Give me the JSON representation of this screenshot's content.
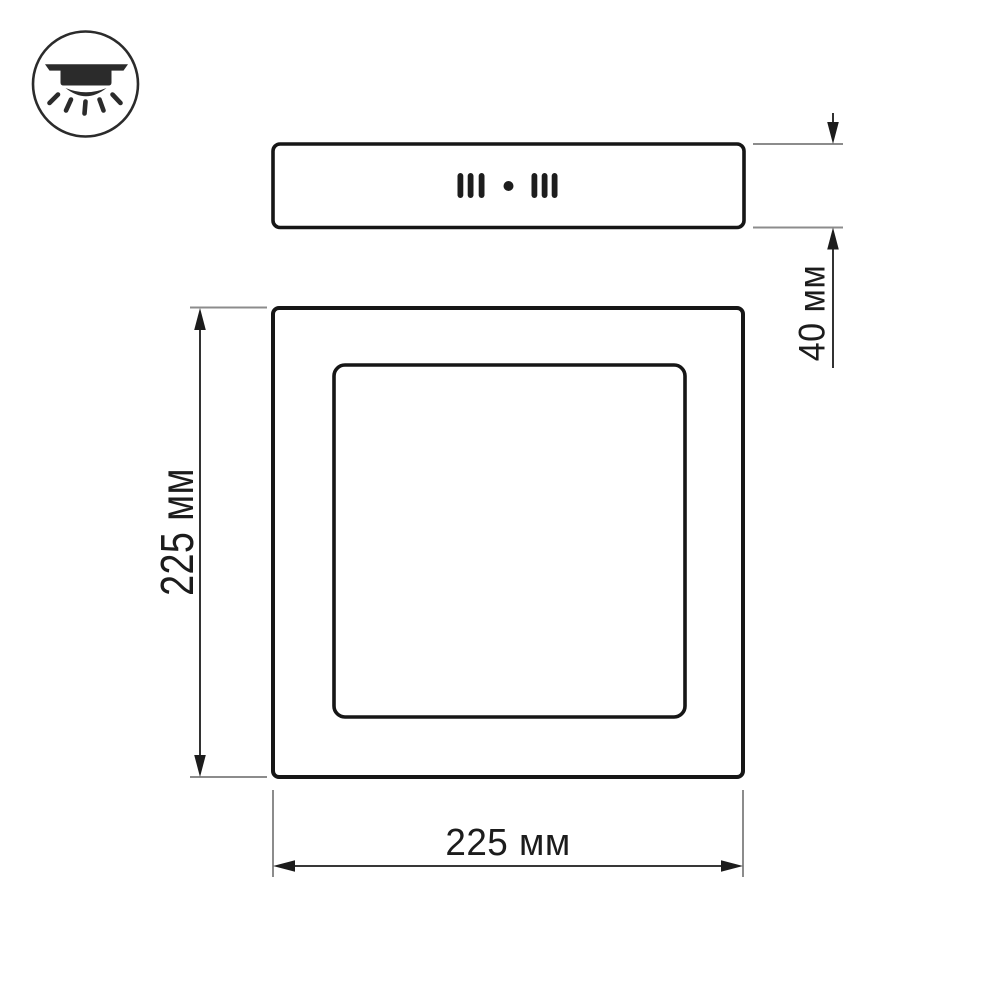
{
  "drawing": {
    "background_color": "#ffffff",
    "outline_color": "#161616",
    "extension_line_color": "#8c8c8c",
    "text_color": "#1c1c1c",
    "icon_color": "#2b2b2b"
  },
  "icon": {
    "name": "surface-mount-downlight-icon",
    "description": "circled pictogram of a surface-mounted ceiling light shining downward"
  },
  "views": {
    "side_profile": {
      "name": "panel-side-view",
      "features": [
        "three-vent-slots-left",
        "center-dot",
        "three-vent-slots-right"
      ]
    },
    "front_face": {
      "name": "panel-front-view",
      "features": [
        "outer-frame",
        "inner-diffuser-square"
      ]
    }
  },
  "dimensions": {
    "thickness": {
      "label": "40 мм",
      "value": 40,
      "unit": "мм",
      "orientation": "vertical",
      "applies_to": "side profile height"
    },
    "height": {
      "label": "225 мм",
      "value": 225,
      "unit": "мм",
      "orientation": "vertical",
      "applies_to": "front face height"
    },
    "width": {
      "label": "225 мм",
      "value": 225,
      "unit": "мм",
      "orientation": "horizontal",
      "applies_to": "front face width"
    }
  }
}
